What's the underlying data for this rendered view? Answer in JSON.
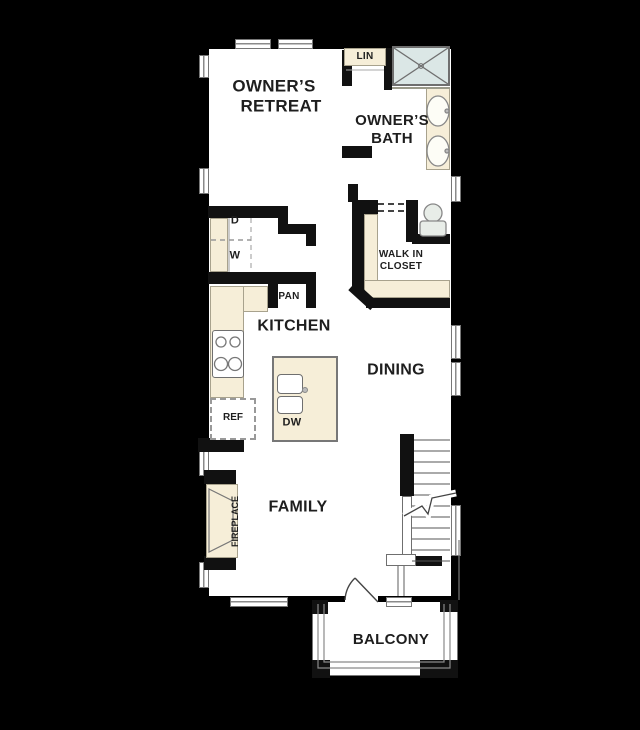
{
  "title": "second-floor-plan",
  "colors": {
    "background": "#000000",
    "floor": "#ffffff",
    "wall": "#111111",
    "cabinet_tan": "#f6eed8",
    "shower_blue": "#dbe7e6",
    "line_gray": "#8a8a8a",
    "label_ink": "#1e1e1e"
  },
  "rooms": {
    "owners_retreat": {
      "line1": "OWNER’S",
      "line2": "RETREAT"
    },
    "owners_bath": {
      "line1": "OWNER’S",
      "line2": "BATH"
    },
    "lin": "LIN",
    "walk_in_closet": {
      "line1": "WALK IN",
      "line2": "CLOSET"
    },
    "kitchen": "KITCHEN",
    "pan": "PAN",
    "dining": "DINING",
    "family": "FAMILY",
    "balcony": "BALCONY"
  },
  "fixtures": {
    "dryer": "D",
    "washer": "W",
    "refrigerator": "REF",
    "dishwasher": "DW",
    "fireplace": "FIREPLACE"
  }
}
